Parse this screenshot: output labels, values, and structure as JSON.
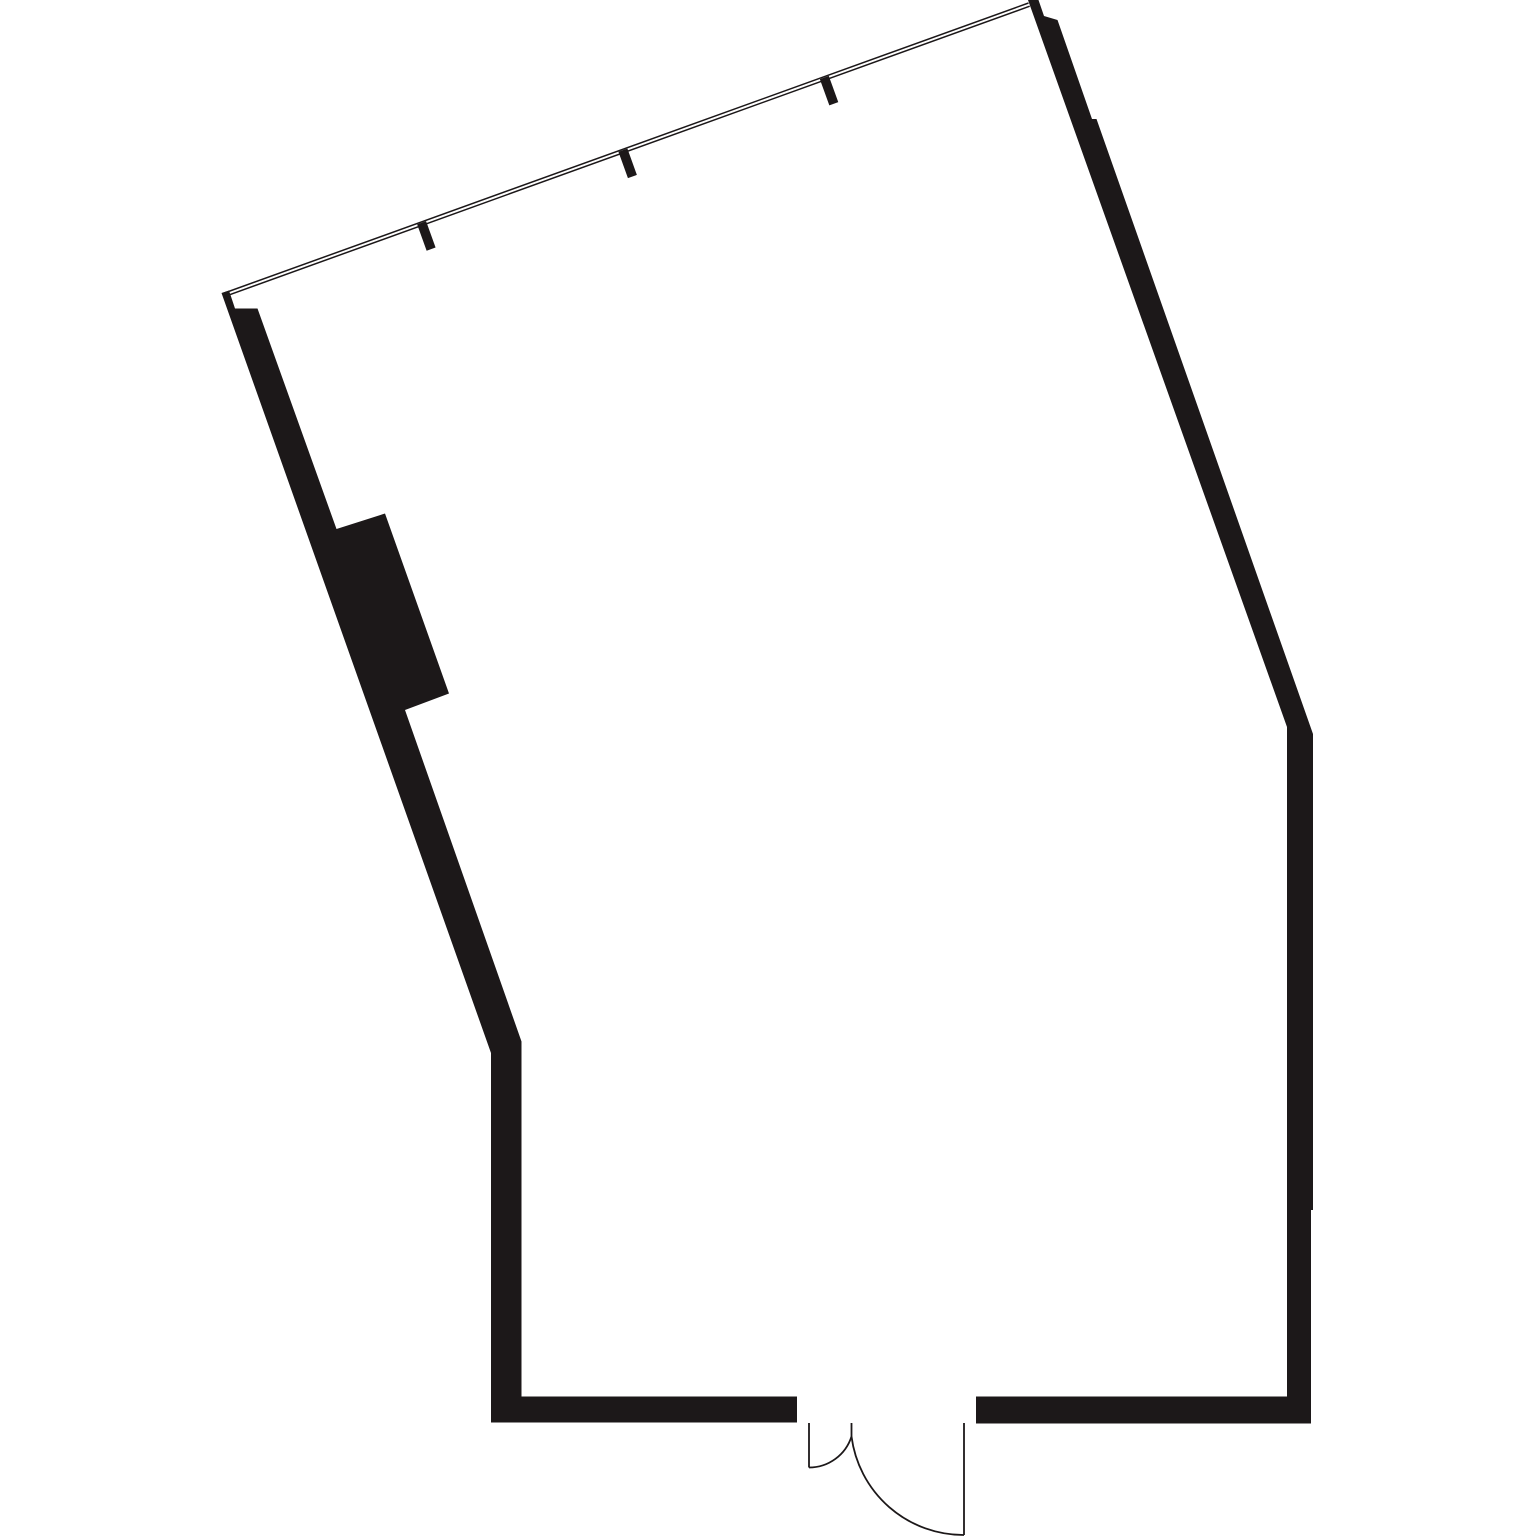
{
  "document": {
    "kind": "architectural-floor-plan",
    "description": "Empty room floor plan, rotated shell with glazed wall at top and double-leaf entrance door at bottom"
  },
  "canvas": {
    "width": 1535,
    "height": 1536,
    "background": "#ffffff"
  },
  "colors": {
    "wall_fill": "#1c1819",
    "line_stroke": "#1c1819"
  },
  "floor_plan": {
    "walls": [
      {
        "name": "left-wall-with-column",
        "points": [
          [
            221.5,
            293
          ],
          [
            229,
            290.5
          ],
          [
            235,
            308.5
          ],
          [
            257.5,
            308.5
          ],
          [
            336.5,
            529
          ],
          [
            385,
            513.5
          ],
          [
            449,
            693.5
          ],
          [
            405,
            710
          ],
          [
            521.5,
            1041.5
          ],
          [
            521.5,
            1396.5
          ],
          [
            797,
            1396.5
          ],
          [
            797,
            1422.5
          ],
          [
            491,
            1422.5
          ],
          [
            491,
            1053
          ]
        ]
      },
      {
        "name": "right-wall-and-bottom-right-wall",
        "points": [
          [
            1028,
            0
          ],
          [
            1038.5,
            0
          ],
          [
            1044,
            16
          ],
          [
            1057.5,
            20
          ],
          [
            1092,
            119
          ],
          [
            1096.5,
            119
          ],
          [
            1313,
            734
          ],
          [
            1313,
            1210
          ],
          [
            1311,
            1210
          ],
          [
            1311,
            1423.5
          ],
          [
            976,
            1423.5
          ],
          [
            976,
            1396.5
          ],
          [
            1287,
            1396.5
          ],
          [
            1287,
            727
          ]
        ]
      }
    ],
    "window": {
      "stroke_width": 1.5,
      "lines": [
        {
          "name": "window-glazing-outer-line",
          "x1": 223,
          "y1": 293.5,
          "x2": 1028.5,
          "y2": 3
        },
        {
          "name": "window-glazing-inner-line",
          "x1": 224.2,
          "y1": 296.7,
          "x2": 1029.7,
          "y2": 6.2
        }
      ],
      "mullion_width": 9.5,
      "mullions": [
        {
          "name": "window-mullion-1",
          "x1": 421.6,
          "y1": 222.8,
          "x2": 431.1,
          "y2": 249.1
        },
        {
          "name": "window-mullion-2",
          "x1": 622.9,
          "y1": 150.1,
          "x2": 632.4,
          "y2": 176.5
        },
        {
          "name": "window-mullion-3",
          "x1": 824.3,
          "y1": 77.5,
          "x2": 833.8,
          "y2": 103.8
        }
      ]
    },
    "door": {
      "stroke_width": 1.8,
      "segments": [
        {
          "name": "door-leaf-left",
          "x1": 809,
          "y1": 1423,
          "x2": 809,
          "y2": 1467.5
        },
        {
          "name": "door-meeting-stile",
          "x1": 851.5,
          "y1": 1423,
          "x2": 851.5,
          "y2": 1436.5
        },
        {
          "name": "door-leaf-right",
          "x1": 964,
          "y1": 1423,
          "x2": 964,
          "y2": 1535
        }
      ],
      "arcs": [
        {
          "name": "door-swing-arc-left",
          "d": "M 809 1467.5 A 44.5 44.5 0 0 0 851.5 1436.5"
        },
        {
          "name": "door-swing-arc-right",
          "d": "M 851.5 1436.5 A 113 113 0 0 0 964 1535"
        }
      ]
    }
  }
}
